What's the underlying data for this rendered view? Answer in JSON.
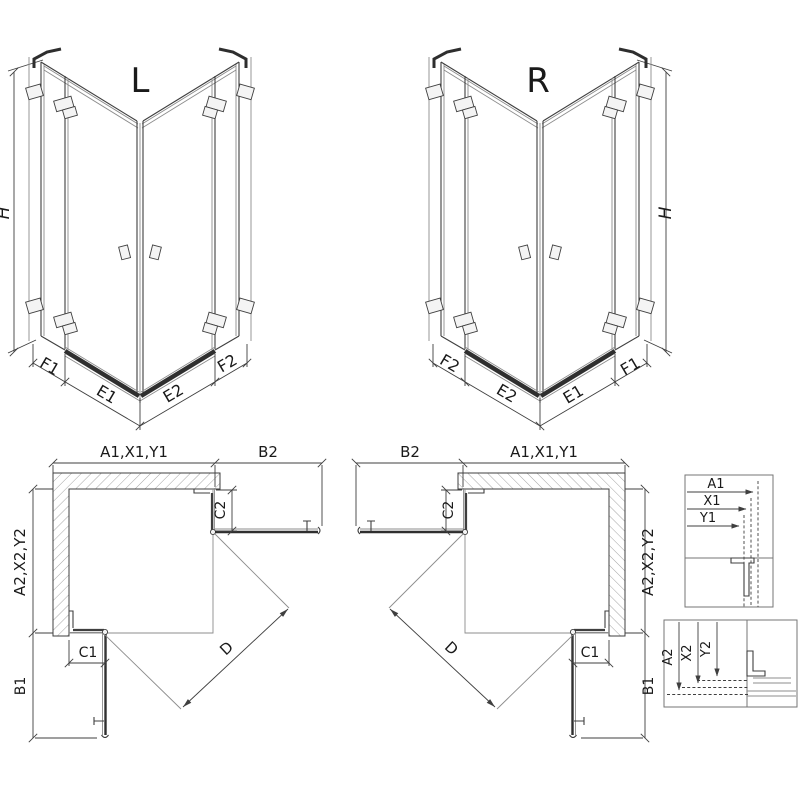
{
  "iso_left": {
    "label": "L",
    "dim_h": "H",
    "dim_f1": "F1",
    "dim_e1": "E1",
    "dim_e2": "E2",
    "dim_f2": "F2"
  },
  "iso_right": {
    "label": "R",
    "dim_h": "H",
    "dim_f1": "F1",
    "dim_e1": "E1",
    "dim_e2": "E2",
    "dim_f2": "F2"
  },
  "plan_left": {
    "dim_top": "A1,X1,Y1",
    "dim_b2": "B2",
    "dim_side": "A2,X2,Y2",
    "dim_c2": "C2",
    "dim_c1": "C1",
    "dim_b1": "B1",
    "dim_d": "D"
  },
  "plan_right": {
    "dim_top": "A1,X1,Y1",
    "dim_b2": "B2",
    "dim_side": "A2,X2,Y2",
    "dim_c2": "C2",
    "dim_c1": "C1",
    "dim_b1": "B1",
    "dim_d": "D"
  },
  "detail_top": {
    "dim_a1": "A1",
    "dim_x1": "X1",
    "dim_y1": "Y1"
  },
  "detail_bottom": {
    "dim_a2": "A2",
    "dim_x2": "X2",
    "dim_y2": "Y2"
  },
  "colors": {
    "background": "#ffffff",
    "line": "#3f3f3f",
    "line_light": "#8c8c8c",
    "threshold": "#2f2f2f",
    "text": "#1a1a1a",
    "hatch": "#9a9a9a"
  }
}
